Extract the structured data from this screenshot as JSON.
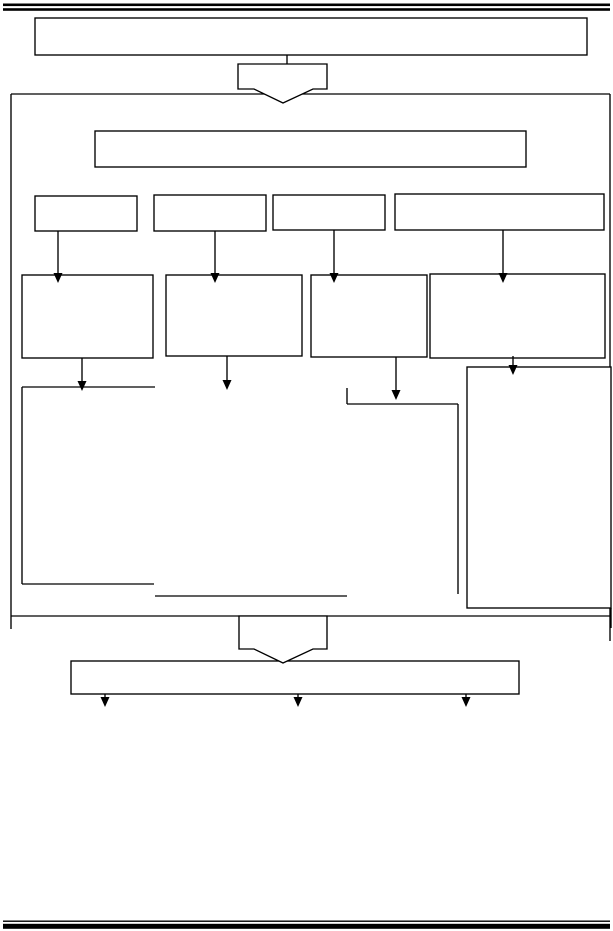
{
  "page": {
    "background_color": "#ffffff",
    "line_color": "#000000",
    "shape_fill_color": "#ffffff"
  },
  "diagram": {
    "rules": [
      {
        "name": "top-rule-upper",
        "x": 3,
        "y": 3.5,
        "w": 607,
        "h": 2.6
      },
      {
        "name": "top-rule-lower",
        "x": 3,
        "y": 8.2,
        "w": 607,
        "h": 2.6
      },
      {
        "name": "bottom-rule-thin",
        "x": 3,
        "y": 920.5,
        "w": 607,
        "h": 1.4
      },
      {
        "name": "bottom-rule-thick",
        "x": 3,
        "y": 923.8,
        "w": 607,
        "h": 5
      }
    ],
    "boxes": [
      {
        "name": "title-box",
        "x": 35,
        "y": 18,
        "w": 552,
        "h": 37,
        "label": ""
      },
      {
        "name": "subtitle-box",
        "x": 95,
        "y": 131,
        "w": 431,
        "h": 36,
        "label": ""
      },
      {
        "name": "row1-box-1",
        "x": 35,
        "y": 196,
        "w": 102,
        "h": 35,
        "label": ""
      },
      {
        "name": "row1-box-2",
        "x": 154,
        "y": 195,
        "w": 112,
        "h": 36,
        "label": ""
      },
      {
        "name": "row1-box-3",
        "x": 273,
        "y": 195,
        "w": 112,
        "h": 35,
        "label": ""
      },
      {
        "name": "row1-box-4",
        "x": 395,
        "y": 194,
        "w": 209,
        "h": 36,
        "label": ""
      },
      {
        "name": "row2-box-1",
        "x": 22,
        "y": 275,
        "w": 131,
        "h": 83,
        "label": ""
      },
      {
        "name": "row2-box-2",
        "x": 166,
        "y": 275,
        "w": 136,
        "h": 81,
        "label": ""
      },
      {
        "name": "row2-box-3",
        "x": 311,
        "y": 275,
        "w": 116,
        "h": 82,
        "label": ""
      },
      {
        "name": "row2-box-4",
        "x": 430,
        "y": 274,
        "w": 175,
        "h": 84,
        "label": ""
      },
      {
        "name": "right-tall-box",
        "x": 467,
        "y": 367,
        "w": 144,
        "h": 241,
        "label": ""
      },
      {
        "name": "bottom-wide-box",
        "x": 71,
        "y": 661,
        "w": 448,
        "h": 33,
        "label": ""
      }
    ],
    "lines": [
      {
        "name": "container-top",
        "x1": 11,
        "y1": 94,
        "x2": 610,
        "y2": 94
      },
      {
        "name": "container-left",
        "x1": 11,
        "y1": 94,
        "x2": 11,
        "y2": 629
      },
      {
        "name": "container-right",
        "x1": 610,
        "y1": 94,
        "x2": 610,
        "y2": 641
      },
      {
        "name": "container-bottom",
        "x1": 11,
        "y1": 616,
        "x2": 610,
        "y2": 616
      },
      {
        "name": "title-connector",
        "x1": 287,
        "y1": 55,
        "x2": 287,
        "y2": 64
      },
      {
        "name": "left-open-box-top",
        "x1": 22,
        "y1": 387,
        "x2": 155,
        "y2": 387
      },
      {
        "name": "left-open-box-left",
        "x1": 22,
        "y1": 387,
        "x2": 22,
        "y2": 584
      },
      {
        "name": "left-open-box-bottom",
        "x1": 22,
        "y1": 584,
        "x2": 154,
        "y2": 584
      },
      {
        "name": "mid-horizontal-line",
        "x1": 155,
        "y1": 596,
        "x2": 347,
        "y2": 596
      },
      {
        "name": "mid-right-top-tick",
        "x1": 347,
        "y1": 388,
        "x2": 347,
        "y2": 404
      },
      {
        "name": "mid-right-horizontal",
        "x1": 347,
        "y1": 404,
        "x2": 458,
        "y2": 404
      },
      {
        "name": "mid-right-vertical",
        "x1": 458,
        "y1": 404,
        "x2": 458,
        "y2": 594
      },
      {
        "name": "right-tall-box-overshoot",
        "x1": 611,
        "y1": 608,
        "x2": 611,
        "y2": 628
      }
    ],
    "arrows": [
      {
        "name": "arrow-row1-to-row2-1",
        "x": 58,
        "y1": 231,
        "y2": 283
      },
      {
        "name": "arrow-row1-to-row2-2",
        "x": 215,
        "y1": 231,
        "y2": 283
      },
      {
        "name": "arrow-row1-to-row2-3",
        "x": 334,
        "y1": 230,
        "y2": 283
      },
      {
        "name": "arrow-row1-to-row2-4",
        "x": 503,
        "y1": 230,
        "y2": 283
      },
      {
        "name": "arrow-row2-down-1",
        "x": 82,
        "y1": 358,
        "y2": 391
      },
      {
        "name": "arrow-row2-down-2",
        "x": 227,
        "y1": 356,
        "y2": 390
      },
      {
        "name": "arrow-row2-down-3",
        "x": 396,
        "y1": 357,
        "y2": 400
      },
      {
        "name": "arrow-row2-down-4",
        "x": 513,
        "y1": 356,
        "y2": 375
      },
      {
        "name": "arrow-bottom-1",
        "x": 105,
        "y1": 694,
        "y2": 707
      },
      {
        "name": "arrow-bottom-2",
        "x": 298,
        "y1": 694,
        "y2": 707
      },
      {
        "name": "arrow-bottom-3",
        "x": 466,
        "y1": 694,
        "y2": 707
      }
    ],
    "block_arrows": [
      {
        "name": "block-arrow-top",
        "points": [
          [
            238,
            64
          ],
          [
            327,
            64
          ],
          [
            327,
            89
          ],
          [
            313,
            89
          ],
          [
            283,
            103
          ],
          [
            254,
            89
          ],
          [
            238,
            89
          ]
        ]
      },
      {
        "name": "block-arrow-bottom",
        "points": [
          [
            239,
            616
          ],
          [
            327,
            616
          ],
          [
            327,
            649
          ],
          [
            313,
            649
          ],
          [
            283,
            663
          ],
          [
            254,
            649
          ],
          [
            239,
            649
          ]
        ]
      }
    ]
  }
}
